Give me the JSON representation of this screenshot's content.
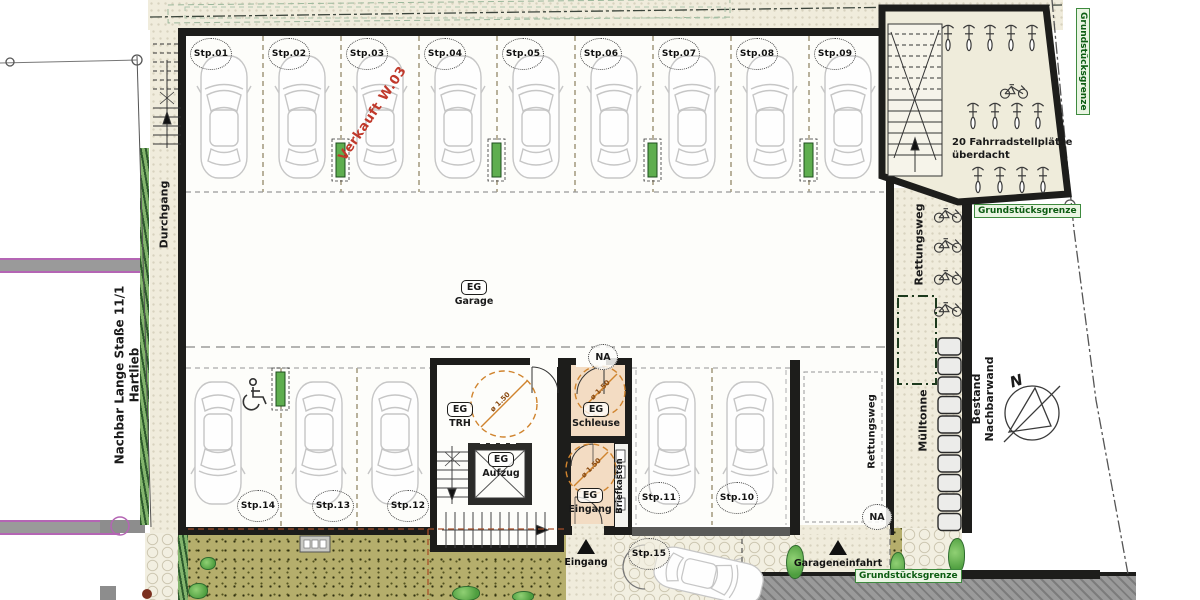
{
  "parking": {
    "top_row": [
      "Stp.01",
      "Stp.02",
      "Stp.03",
      "Stp.04",
      "Stp.05",
      "Stp.06",
      "Stp.07",
      "Stp.08",
      "Stp.09"
    ],
    "bottom_row": [
      "Stp.14",
      "Stp.13",
      "Stp.12",
      "Stp.11",
      "Stp.10"
    ],
    "outside_spot": "Stp.15",
    "sold_note": "Verkauft  W.03"
  },
  "rooms": {
    "garage": {
      "tag": "EG",
      "name": "Garage"
    },
    "trh": {
      "tag": "EG",
      "name": "TRH"
    },
    "aufzug": {
      "tag": "EG",
      "name": "Aufzug"
    },
    "schleuse": {
      "tag": "EG",
      "name": "Schleuse"
    },
    "eingang": {
      "tag": "EG",
      "name": "Eingang"
    },
    "briefkasten": "Briefkasten",
    "na": "NA",
    "turning_circle": "ø 1.50"
  },
  "bike_shelter": {
    "line1": "20 Fahrradstellplätze",
    "line2": "überdacht"
  },
  "annotations": {
    "grundstuecksgrenze": "Grundstücksgrenze",
    "durchgang": "Durchgang",
    "nachbar_line1": "Nachbar Lange Staße  11/1",
    "nachbar_line2": "Hartlieb",
    "rettungsweg": "Rettungsweg",
    "muelltonne": "Mülltonne",
    "bestand_nachbarwand": "Bestand Nachbarwand",
    "eingang_outside": "Eingang",
    "garageneinfahrt": "Garageneinfahrt",
    "north": "N"
  },
  "colors": {
    "wall": "#1d1d1b",
    "paving": "#f0ecdc",
    "garden": "#b5ae6c",
    "room_floor": "#f3dcc3",
    "sold_red": "#c0392b",
    "boundary_green": "#0c5c12",
    "circle_orange": "#d0842e"
  }
}
